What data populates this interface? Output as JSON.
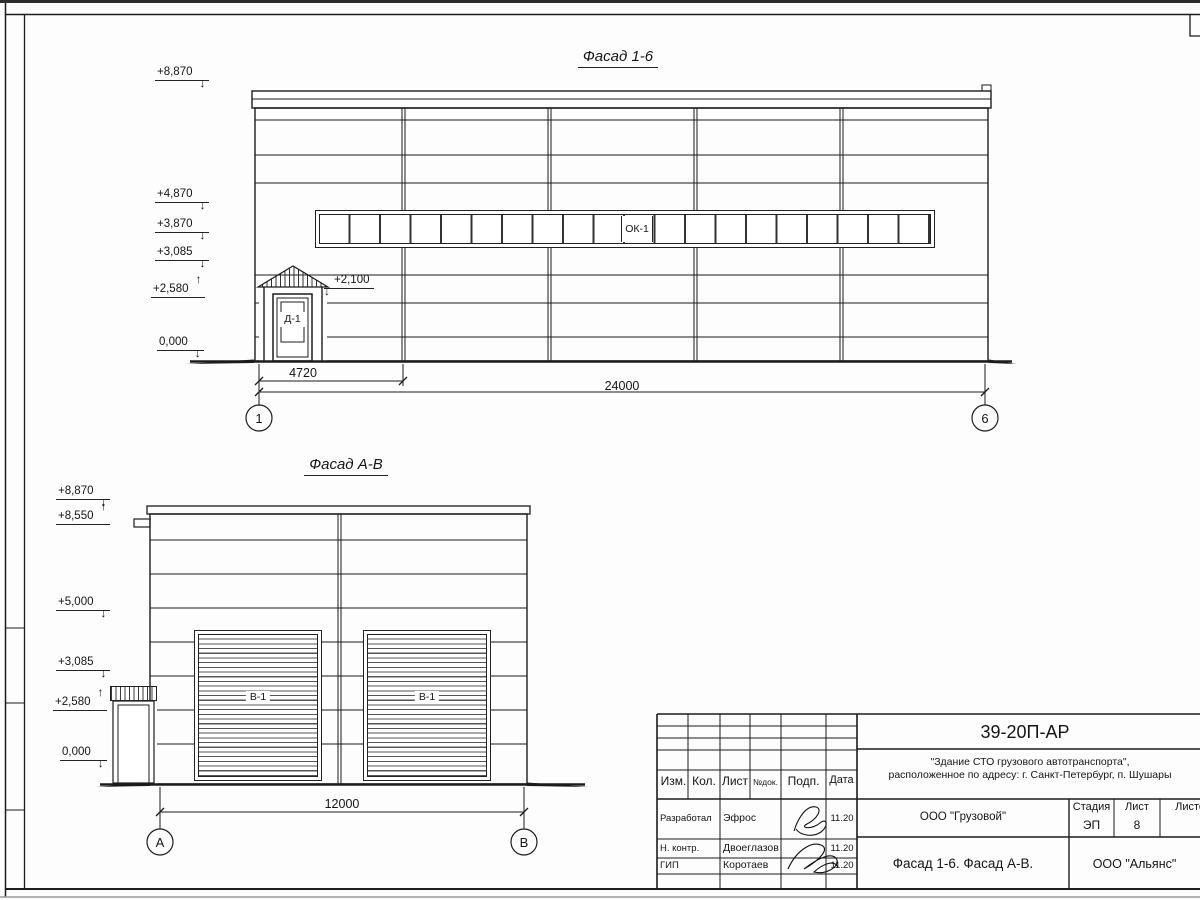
{
  "icons": {
    "arrow_down": "↓",
    "arrow_up": "↑"
  },
  "fasad16": {
    "title": "Фасад 1-6",
    "elevations": [
      "+8,870",
      "+4,870",
      "+3,870",
      "+3,085",
      "+2,580",
      "0,000",
      "+2,100"
    ],
    "window_label": "ОК-1",
    "door_label": "Д-1",
    "dim_bay": "4720",
    "dim_total": "24000",
    "axis_left": "1",
    "axis_right": "6"
  },
  "fasadAB": {
    "title": "Фасад А-В",
    "elevations": [
      "+8,870",
      "+8,550",
      "+5,000",
      "+3,085",
      "+2,580",
      "0,000"
    ],
    "gate_label": "В-1",
    "gate_label_2": "В-1",
    "dim_total": "12000",
    "axis_left": "А",
    "axis_right": "В"
  },
  "titleblock": {
    "doc_number": "39-20П-АР",
    "project_line1": "\"Здание СТО грузового автотранспорта\",",
    "project_line2": "расположенное по адресу: г. Санкт-Петербург, п. Шушары",
    "client": "ООО \"Грузовой\"",
    "sheet_title": "Фасад 1-6. Фасад А-В.",
    "company": "ООО \"Альянс\"",
    "headers": {
      "izm": "Изм.",
      "kol": "Кол.",
      "list": "Лист",
      "ndok": "№док.",
      "podp": "Подп.",
      "data": "Дата",
      "stage": "Стадия",
      "sheet": "Лист",
      "sheets": "Листов"
    },
    "stage_value": "ЭП",
    "sheet_value": "8",
    "rows": [
      {
        "role": "Разработал",
        "name": "Эфрос",
        "date": "11.20"
      },
      {
        "role": "Н. контр.",
        "name": "Двоеглазов",
        "date": "11.20"
      },
      {
        "role": "ГИП",
        "name": "Коротаев",
        "date": "11.20"
      }
    ]
  }
}
